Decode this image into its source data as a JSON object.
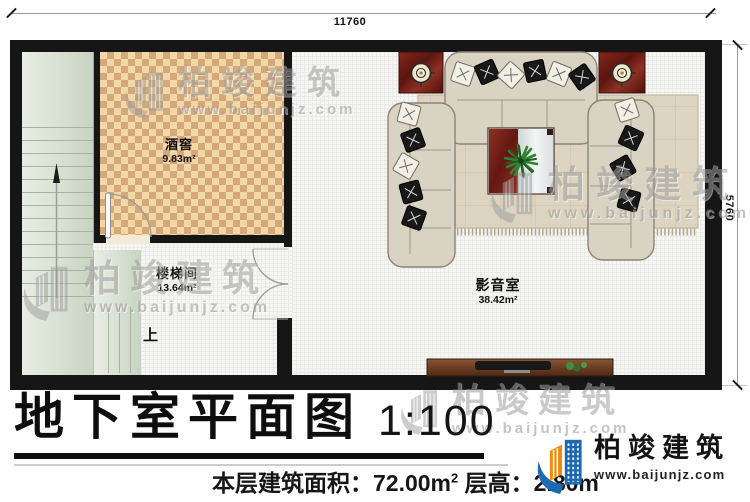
{
  "dimensions": {
    "top": "11760",
    "right": "5760"
  },
  "rooms": [
    {
      "name": "酒窖",
      "area": "9.83m²"
    },
    {
      "name": "楼梯间",
      "area": "13.64m²"
    },
    {
      "name": "影音室",
      "area": "38.42m²"
    }
  ],
  "stairs": {
    "up_label": "上"
  },
  "title": {
    "text": "地下室平面图",
    "scale": "1:100"
  },
  "footer": {
    "area_label": "本层建筑面积：72.00m",
    "area_sup": "2",
    "height_label": " 层高：2.80m"
  },
  "brand": {
    "name": "柏竣建筑",
    "website": "www.baijunjz.com"
  },
  "watermark": {
    "name": "柏竣建筑",
    "website": "www.baijunjz.com"
  },
  "colors": {
    "wall": "#161616",
    "brand_blue": "#1d69b4",
    "brand_orange": "#f08c0a",
    "stair_green": "#d7e0d1",
    "cellar_tile_light": "#f2d8a6",
    "cellar_tile_dark": "#d5a87c",
    "mat_red": "#6e1f19"
  }
}
